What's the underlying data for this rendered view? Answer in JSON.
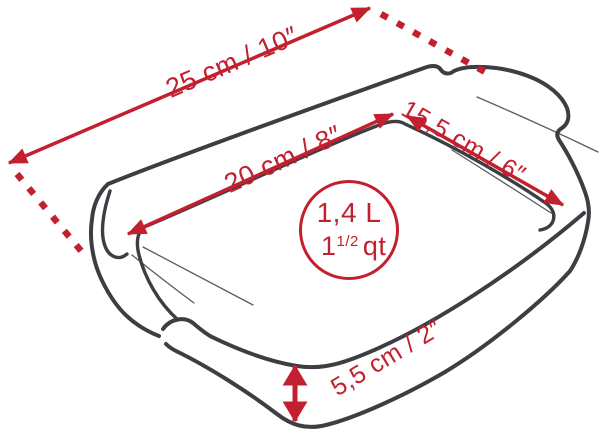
{
  "colors": {
    "red": "#c3202f",
    "dark": "#3b3e43",
    "bg": "#ffffff"
  },
  "product": {
    "dimensions": {
      "outer_length": "25 cm / 10″",
      "inner_length": "20 cm / 8″",
      "inner_width": "15,5 cm / 6″",
      "height": "5,5 cm / 2″"
    },
    "capacity": {
      "liters": "1,4 L",
      "quarts_whole": "1",
      "quarts_fraction": "1/2",
      "quarts_unit": "qt"
    }
  }
}
